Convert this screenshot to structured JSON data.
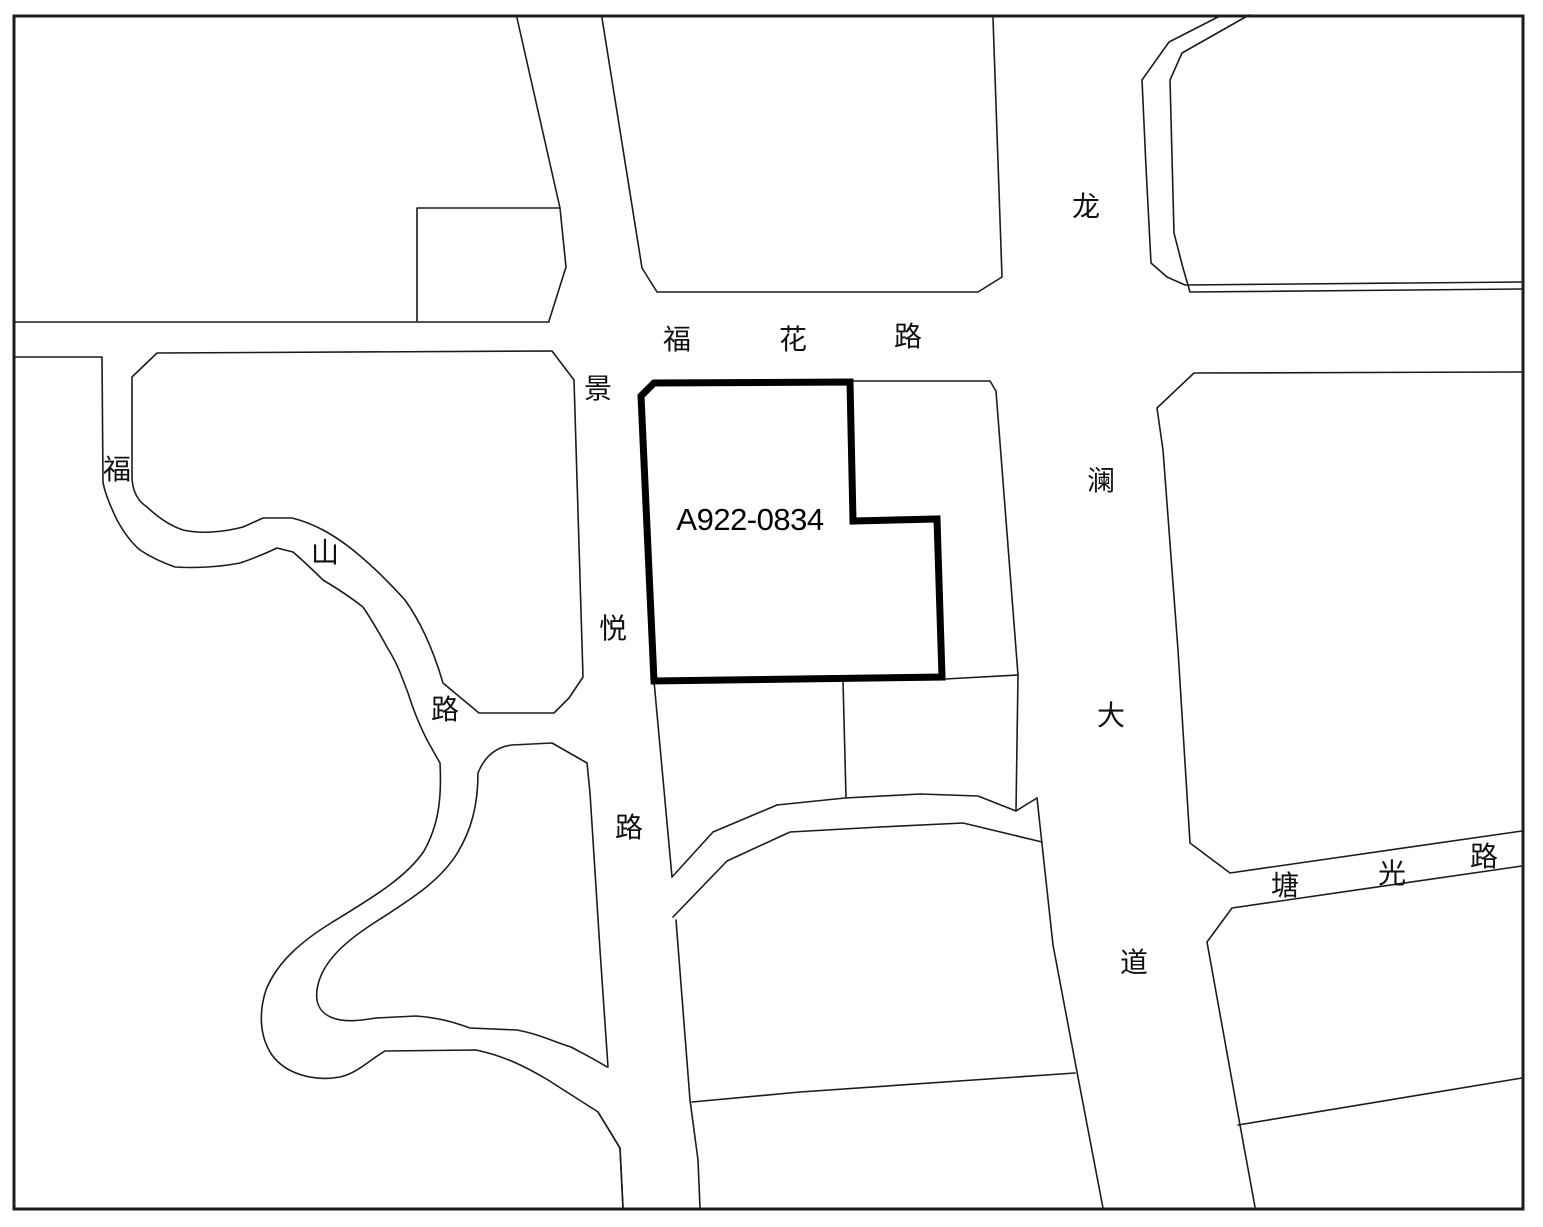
{
  "map": {
    "parcel": {
      "id": "A922-0834"
    },
    "roads": {
      "fuhua": {
        "name": "福花路",
        "chars": [
          "福",
          "花",
          "路"
        ]
      },
      "jingyue": {
        "name": "景悦路",
        "chars": [
          "景",
          "悦",
          "路"
        ]
      },
      "fushan": {
        "name": "福山路",
        "chars": [
          "福",
          "山",
          "路"
        ]
      },
      "longlan": {
        "name": "龙澜大道",
        "chars": [
          "龙",
          "澜",
          "大",
          "道"
        ]
      },
      "tangguang": {
        "name": "塘光路",
        "chars": [
          "塘",
          "光",
          "路"
        ]
      }
    },
    "colors": {
      "line": "#1c1c1c",
      "parcel_outline": "#000000",
      "background": "#ffffff"
    }
  }
}
